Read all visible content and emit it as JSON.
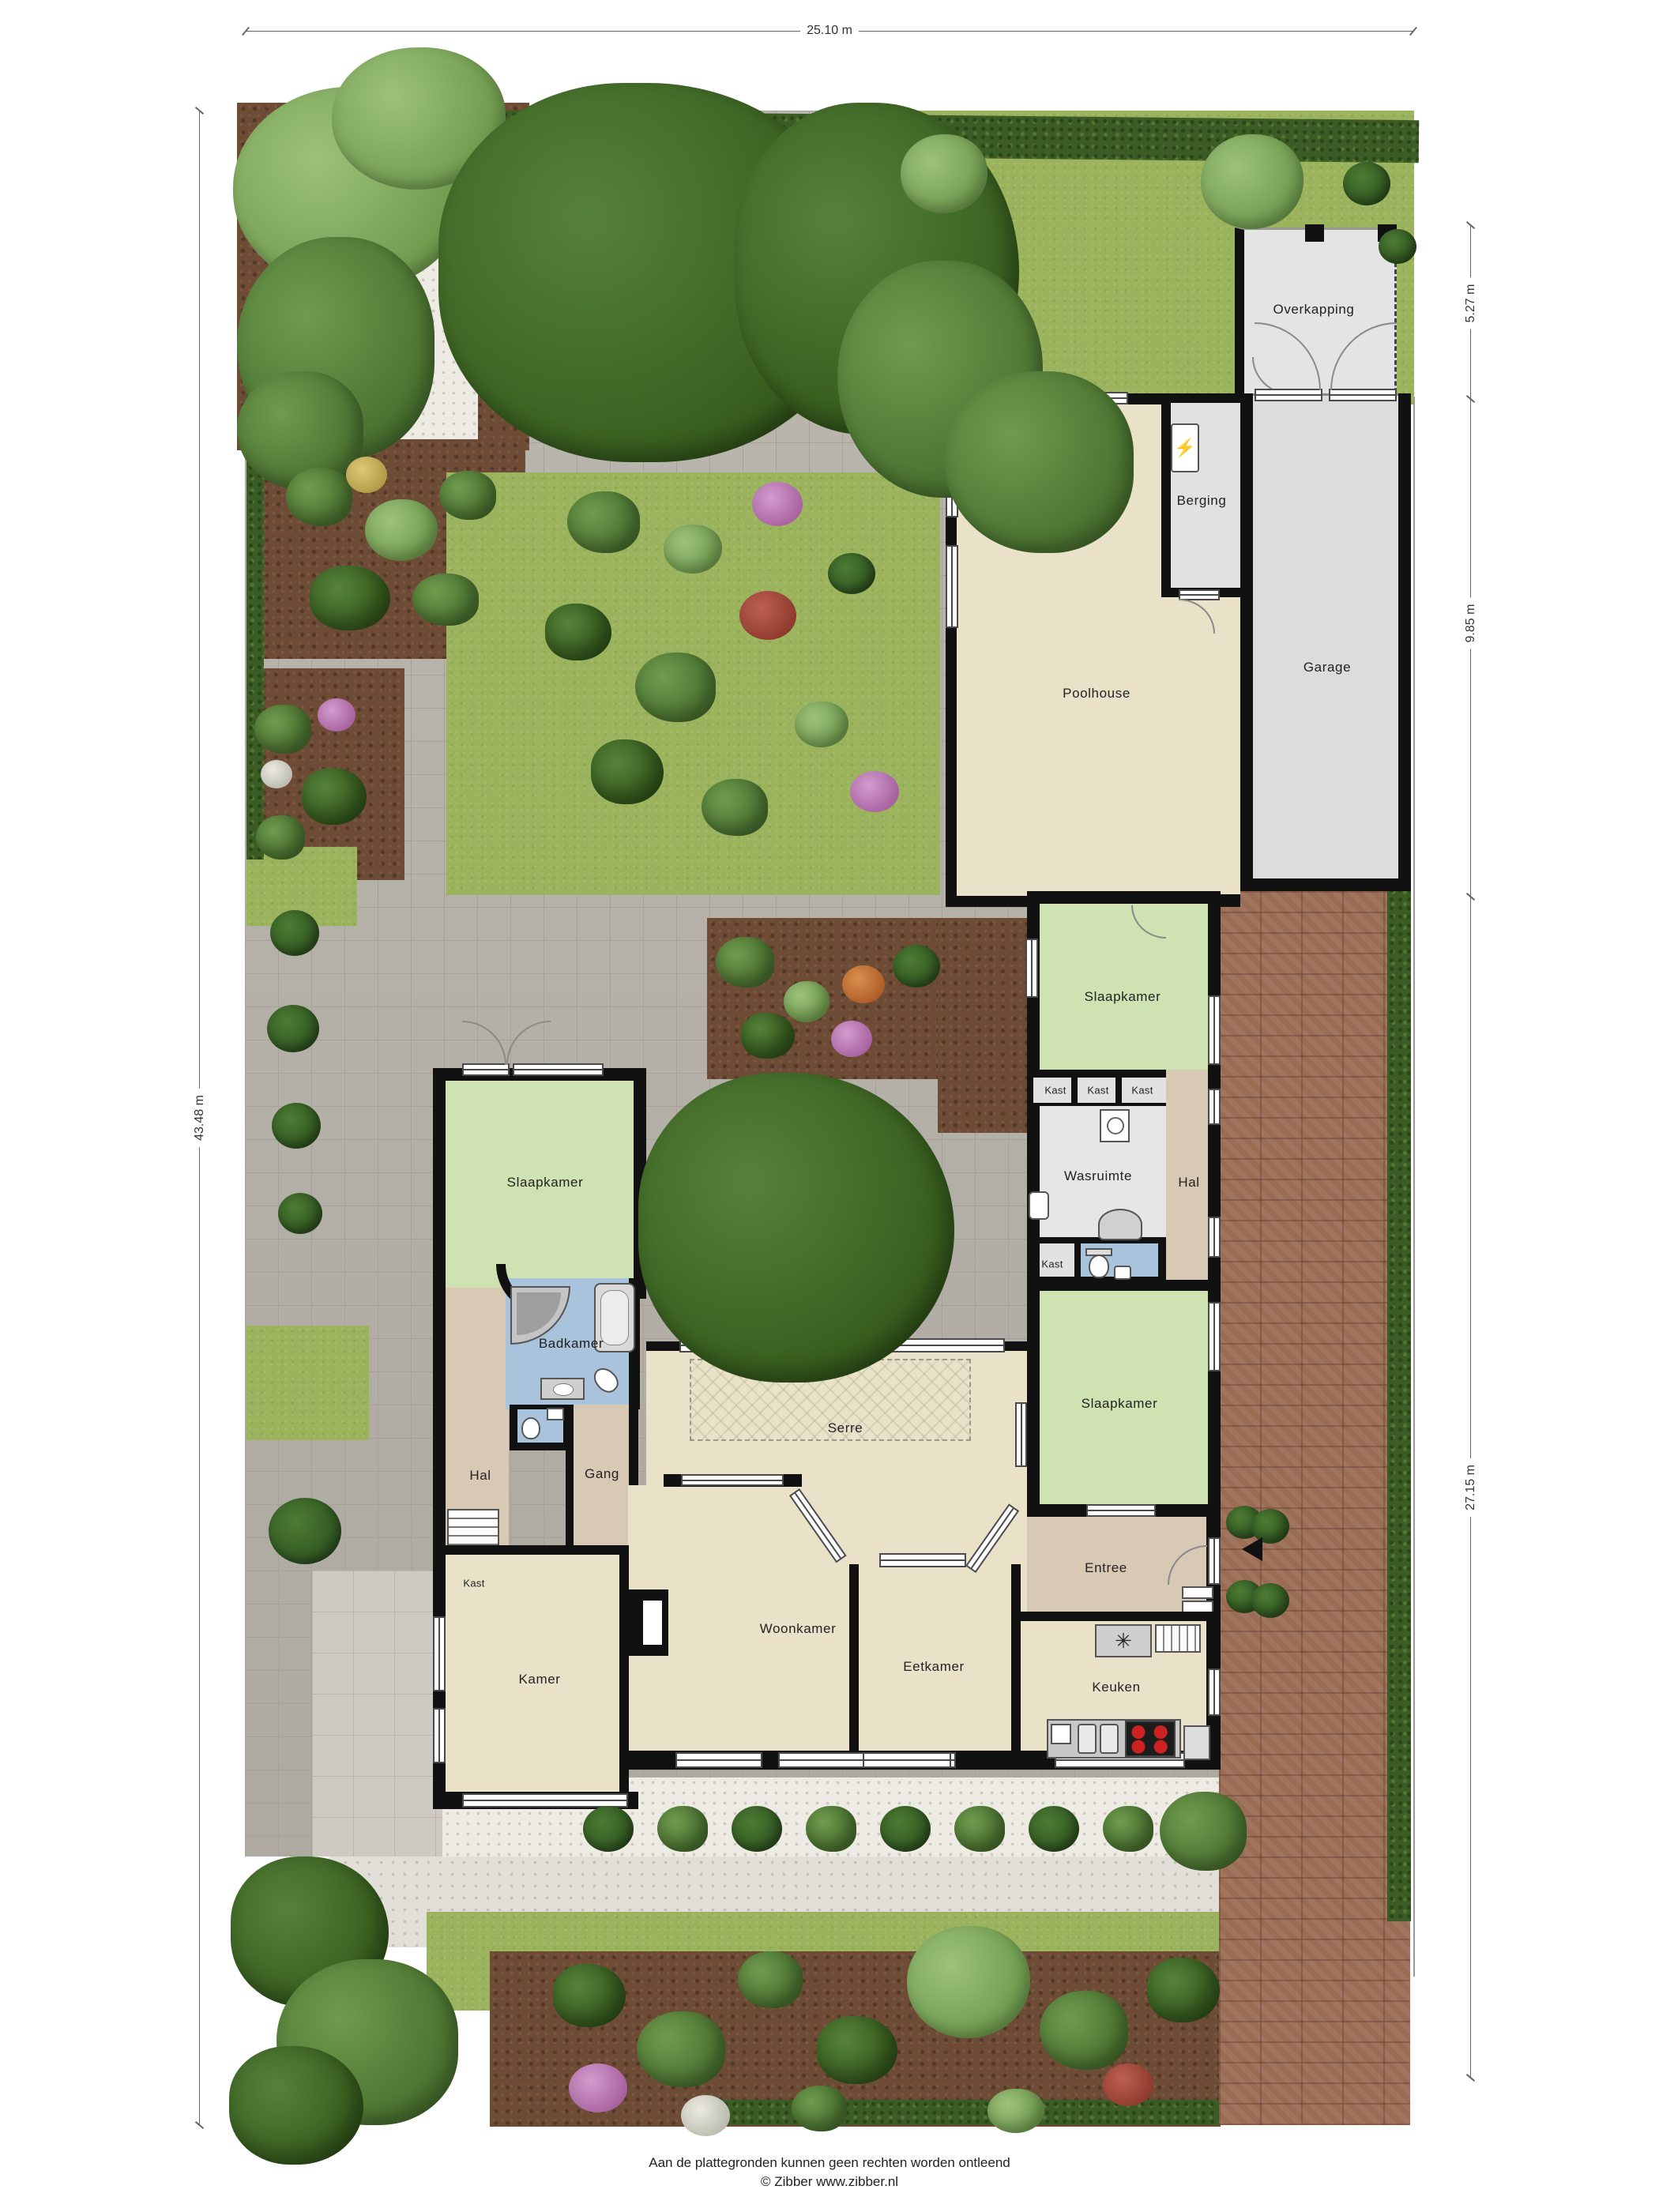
{
  "dimensions": {
    "top": "25.10 m",
    "left": "43.48 m",
    "right_top": "5.27 m",
    "right_mid": "9.85 m",
    "right_bottom": "27.15 m"
  },
  "rooms": {
    "overkapping": "Overkapping",
    "garage": "Garage",
    "berging": "Berging",
    "poolhouse": "Poolhouse",
    "slaapkamer": "Slaapkamer",
    "kast": "Kast",
    "wasruimte": "Wasruimte",
    "hal": "Hal",
    "gang": "Gang",
    "entree": "Entree",
    "badkamer": "Badkamer",
    "serre": "Serre",
    "kamer": "Kamer",
    "woonkamer": "Woonkamer",
    "eetkamer": "Eetkamer",
    "keuken": "Keuken"
  },
  "icons": {
    "boiler": "⚡",
    "fan": "✳",
    "arrow_down": "▼"
  },
  "footer": {
    "disclaimer": "Aan de plattegronden kunnen geen rechten worden ontleend",
    "copyright": "© Zibber www.zibber.nl"
  },
  "colors": {
    "wall": "#111111",
    "room_cream": "#eae2c8",
    "room_green": "#cfe2b2",
    "room_tan": "#d8c9b5",
    "room_blue": "#a9c3dd",
    "room_gray": "#e2e2e2",
    "grass": "#9ab35c",
    "hedge": "#3c5c26",
    "paving": "#b7b3aa",
    "brick": "#9a6c54",
    "soil": "#6d4b34"
  }
}
